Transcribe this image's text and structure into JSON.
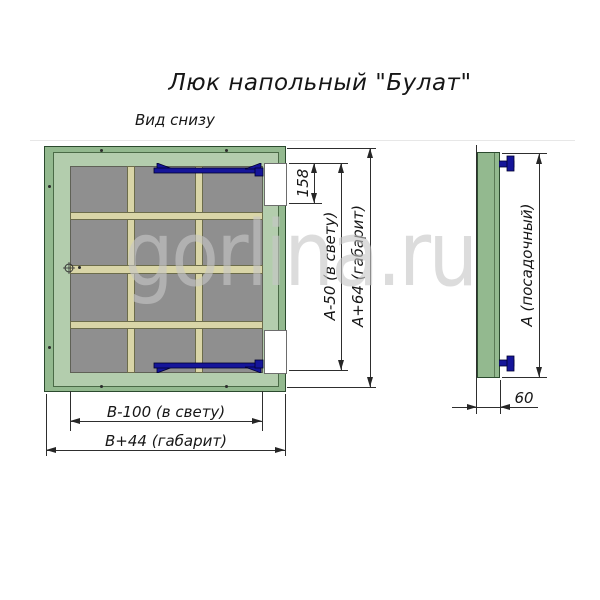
{
  "title": "Люк напольный \"Булат\"",
  "watermark": "gorlina.ru",
  "views": {
    "bottom": {
      "label": "Вид снизу",
      "grid": {
        "columns": 3,
        "rows": 4
      },
      "hinge_count": 2
    },
    "side": {
      "depth_label": "60"
    }
  },
  "dims": {
    "notch": "158",
    "clear_h": "А-50 (в свету)",
    "overall_h": "А+64 (габарит)",
    "clear_w": "В-100 (в свету)",
    "overall_w": "В+44 (габарит)",
    "seat": "А (посадочный)",
    "depth": "60"
  },
  "colors": {
    "frame_green": "#93b98f",
    "flange_green": "#b3cdad",
    "panel_gray": "#8f8f8f",
    "rib_beige": "#d9d5a7",
    "hinge_navy": "#15159a",
    "watermark_gray": "#c7c7c7",
    "line": "#2e2e2e"
  }
}
